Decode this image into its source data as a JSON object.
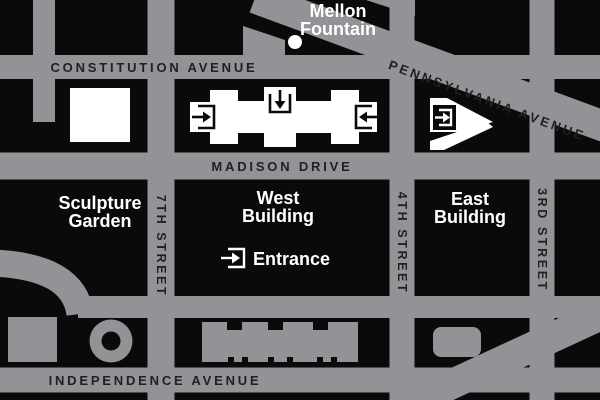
{
  "map": {
    "title": "National Gallery of Art area map",
    "colors": {
      "street": "#919396",
      "background": "#0A0A0B",
      "label_dark": "#231F20",
      "white": "#FFFFFF"
    },
    "mellon": {
      "line1": "Mellon",
      "line2": "Fountain"
    },
    "streets": {
      "constitution": "CONSTITUTION AVENUE",
      "pennsylvania": "PENNSYLVANIA AVENUE",
      "madison": "MADISON DRIVE",
      "independence": "INDEPENDENCE AVENUE",
      "seventh": "7TH STREET",
      "fourth": "4TH STREET",
      "third": "3RD STREET"
    },
    "places": {
      "sculpture_line1": "Sculpture",
      "sculpture_line2": "Garden",
      "west_line1": "West",
      "west_line2": "Building",
      "east_line1": "East",
      "east_line2": "Building",
      "entrance": "Entrance"
    }
  }
}
